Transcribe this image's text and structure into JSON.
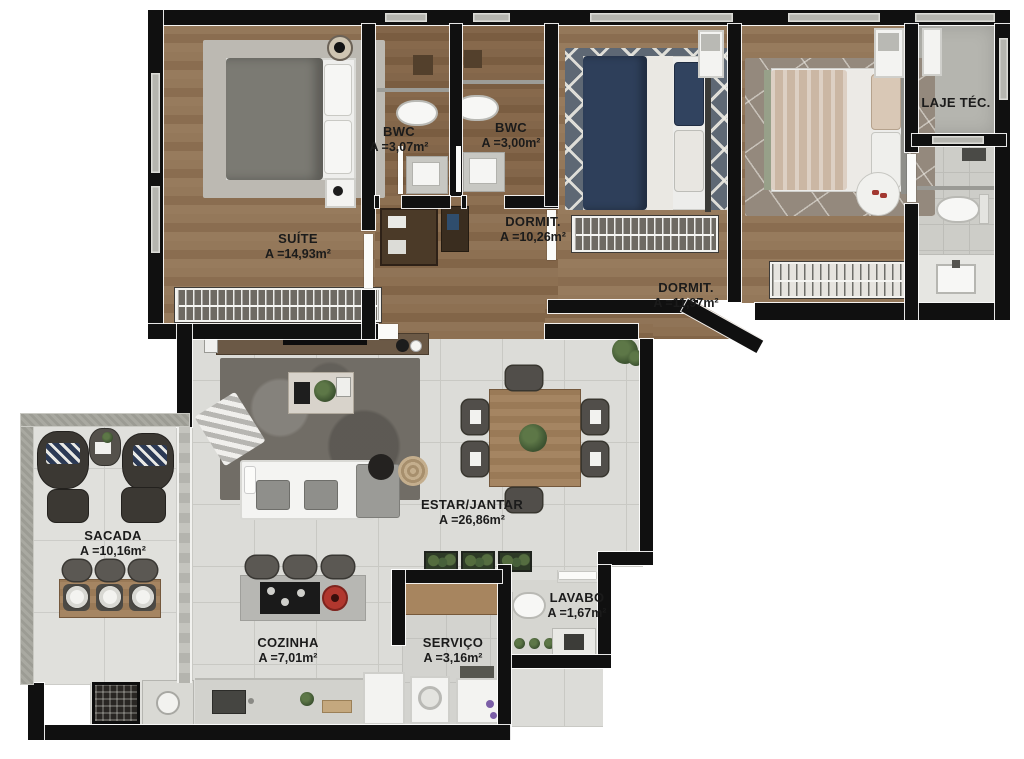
{
  "plan": {
    "type": "apartment-floor-plan",
    "rooms": [
      {
        "id": "suite",
        "name": "SUÍTE",
        "area": "A =14,93m²"
      },
      {
        "id": "bwc1",
        "name": "BWC",
        "area": "A =3,07m²"
      },
      {
        "id": "bwc2",
        "name": "BWC",
        "area": "A =3,00m²"
      },
      {
        "id": "dormit1",
        "name": "DORMIT.",
        "area": "A =10,26m²"
      },
      {
        "id": "dormit2",
        "name": "DORMIT.",
        "area": "A =11,97m²"
      },
      {
        "id": "laje",
        "name": "LAJE TÉC.",
        "area": ""
      },
      {
        "id": "sacada",
        "name": "SACADA",
        "area": "A =10,16m²"
      },
      {
        "id": "estar",
        "name": "ESTAR/JANTAR",
        "area": "A =26,86m²"
      },
      {
        "id": "cozinha",
        "name": "COZINHA",
        "area": "A =7,01m²"
      },
      {
        "id": "servico",
        "name": "SERVIÇO",
        "area": "A =3,16m²"
      },
      {
        "id": "lavabo",
        "name": "LAVABO",
        "area": "A =1,67m²"
      }
    ],
    "colors": {
      "wall": "#101010",
      "wood_floor": "#8f7355",
      "tile_floor": "#dcdcd8",
      "rug_navy": "#2e3f5a",
      "pot_red": "#b1372e",
      "plant_green": "#3c5230"
    }
  }
}
